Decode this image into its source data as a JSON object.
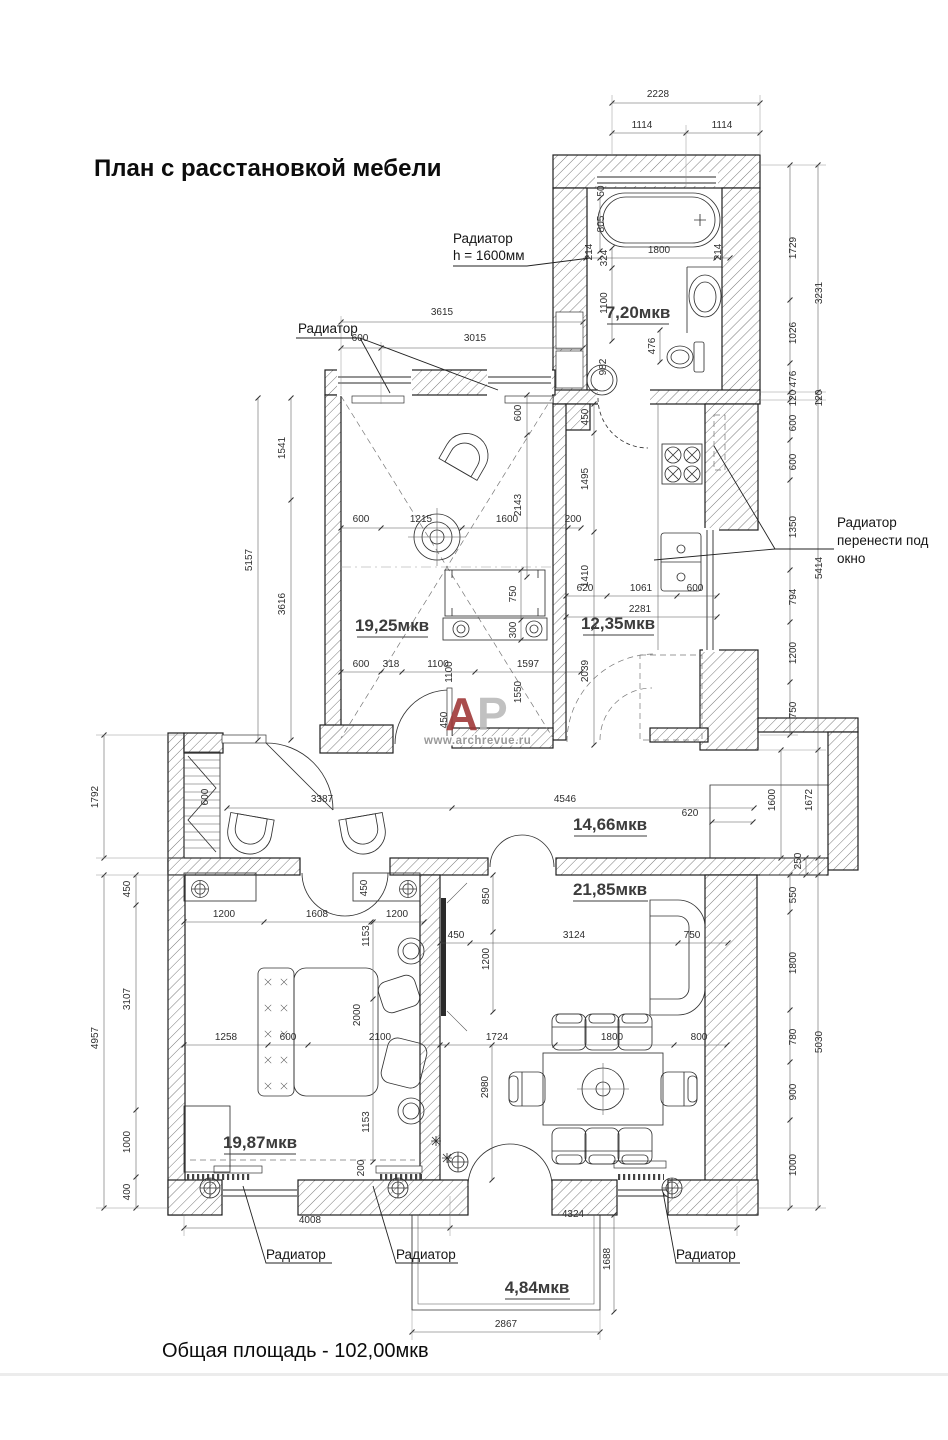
{
  "title": "План с расстановкой мебели",
  "total_area": "Общая площадь - 102,00мкв",
  "watermark": {
    "a": "А",
    "p": "Р",
    "url": "www.archrevue.ru"
  },
  "colors": {
    "wm_a": "#9e3434",
    "wm_p": "#b9b9b9",
    "wall_line": "#1f1f1f",
    "dim_text": "#2e2e2e"
  },
  "rooms": {
    "bathroom": "7,20мкв",
    "living": "19,25мкв",
    "kitchen": "12,35мкв",
    "hall": "14,66мкв",
    "dining": "21,85мкв",
    "bedroom": "19,87мкв",
    "balcony": "4,84мкв"
  },
  "labels": {
    "radiator1": "Радиатор",
    "radiator1_h": "h = 1600мм",
    "radiator2": "Радиатор",
    "radiator_move1": "Радиатор",
    "radiator_move2": "перенести под",
    "radiator_move3": "окно",
    "radiator_b1": "Радиатор",
    "radiator_b2": "Радиатор",
    "radiator_b3": "Радиатор"
  },
  "dim_labels": [
    "2228",
    "1114",
    "1114",
    "1729",
    "3231",
    "1026",
    "476",
    "120",
    "120",
    "600",
    "600",
    "1350",
    "5414",
    "794",
    "1200",
    "750",
    "1600",
    "1672",
    "250",
    "550",
    "1800",
    "780",
    "900",
    "1000",
    "5030",
    "1792",
    "4957",
    "450",
    "3107",
    "1000",
    "400",
    "1541",
    "5157",
    "3616",
    "600",
    "3615",
    "3015",
    "600",
    "2143",
    "600",
    "1215",
    "1600",
    "200",
    "750",
    "300",
    "600",
    "318",
    "1100",
    "1100",
    "1597",
    "1550",
    "450",
    "450",
    "1495",
    "1410",
    "620",
    "1061",
    "600",
    "2281",
    "2039",
    "50",
    "805",
    "214",
    "324",
    "1800",
    "214",
    "1100",
    "476",
    "982",
    "600",
    "3387",
    "4546",
    "620",
    "1200",
    "1608",
    "1200",
    "450",
    "1153",
    "1258",
    "600",
    "2000",
    "2100",
    "1153",
    "200",
    "850",
    "450",
    "3124",
    "750",
    "1200",
    "1724",
    "1800",
    "800",
    "2980",
    "4008",
    "4324",
    "1688",
    "2867"
  ]
}
